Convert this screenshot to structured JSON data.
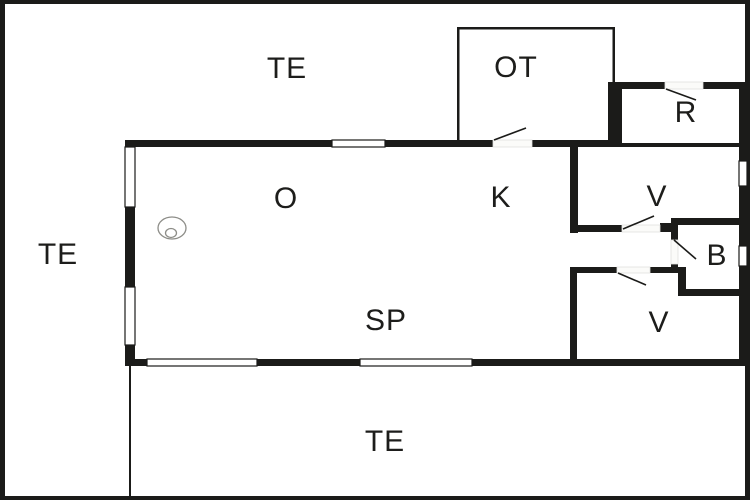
{
  "title": "Holiday home floor plan",
  "colors": {
    "background": "#ffffff",
    "wall": "#1b1b19",
    "label": "#1d1d1b",
    "symbol_stroke": "#8d8d88",
    "window_fill": "#ffffff"
  },
  "rooms": {
    "te_top": {
      "label": "TE"
    },
    "ot": {
      "label": "OT"
    },
    "r": {
      "label": "R"
    },
    "o": {
      "label": "O"
    },
    "k": {
      "label": "K"
    },
    "v_upper": {
      "label": "V"
    },
    "te_left": {
      "label": "TE"
    },
    "b": {
      "label": "B"
    },
    "v_lower": {
      "label": "V"
    },
    "sp": {
      "label": "SP"
    },
    "te_bottom": {
      "label": "TE"
    }
  },
  "icons": {
    "stove": "concentric-oval-burner-symbol"
  }
}
